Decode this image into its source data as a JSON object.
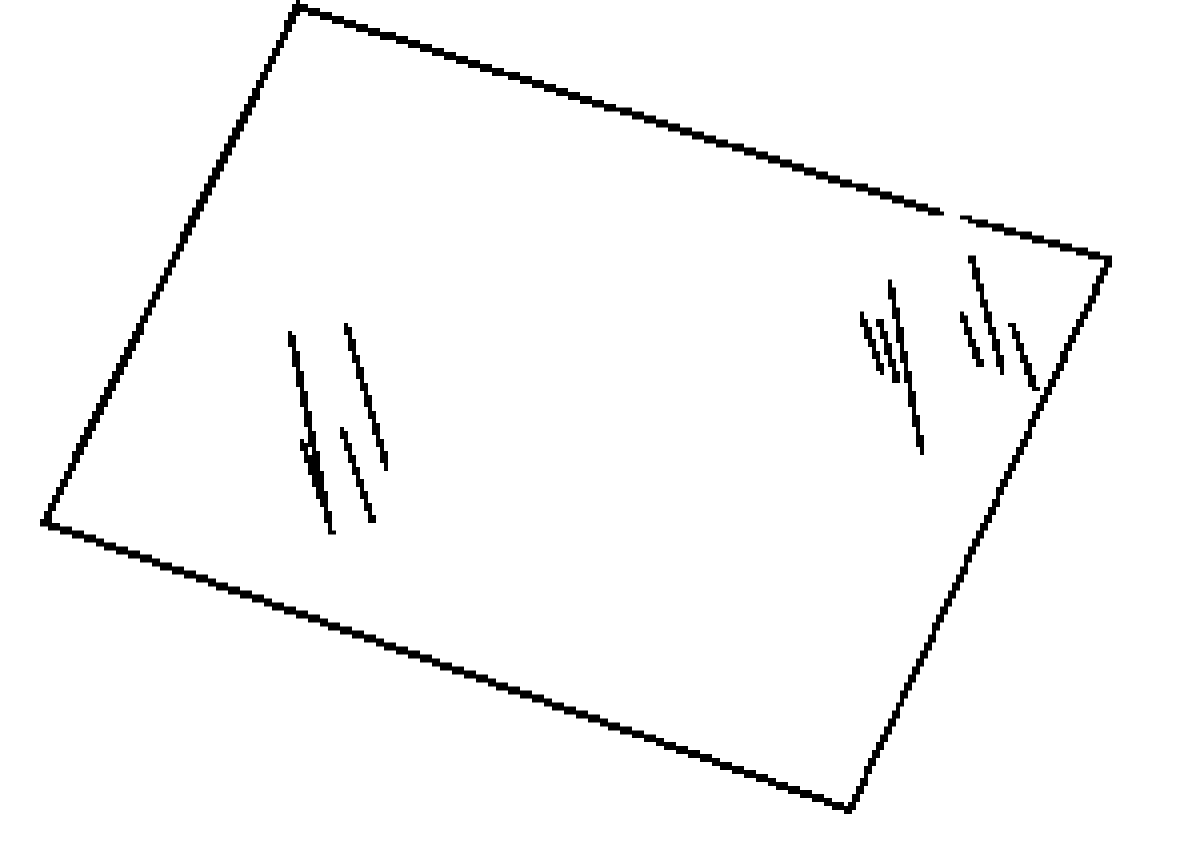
{
  "figure": {
    "description": "Black-and-white line drawing of a tilted rectangular glass pane with diagonal reflection hatch marks",
    "background_color": "#ffffff",
    "stroke_color": "#000000",
    "canvas": {
      "width": 1200,
      "height": 842,
      "pixel_scale": 4
    },
    "pane_outline": {
      "corners": {
        "top": [
          298,
          7
        ],
        "right": [
          1110,
          260
        ],
        "bottom": [
          850,
          812
        ],
        "left": [
          44,
          524
        ]
      },
      "segments": [
        {
          "name": "left-edge",
          "points": [
            [
              298,
              7
            ],
            [
              44,
              524
            ]
          ],
          "width": 7
        },
        {
          "name": "bottom-edge",
          "points": [
            [
              44,
              524
            ],
            [
              850,
              812
            ]
          ],
          "width": 7
        },
        {
          "name": "right-edge",
          "points": [
            [
              850,
              812
            ],
            [
              1110,
              260
            ]
          ],
          "width": 6
        },
        {
          "name": "top-edge-a",
          "points": [
            [
              298,
              7
            ],
            [
              941,
              214
            ]
          ],
          "width": 7
        },
        {
          "name": "top-edge-dot",
          "points": [
            [
              964,
              217
            ],
            [
              972,
              220
            ]
          ],
          "width": 5
        },
        {
          "name": "top-edge-b",
          "points": [
            [
              979,
              223
            ],
            [
              1110,
              260
            ]
          ],
          "width": 6
        }
      ]
    },
    "reflection_marks": {
      "left_group": [
        {
          "name": "left-mark-1",
          "points": [
            [
              291,
              336
            ],
            [
              331,
              533
            ]
          ],
          "width": 5.5
        },
        {
          "name": "left-mark-2",
          "points": [
            [
              347,
              329
            ],
            [
              387,
              468
            ]
          ],
          "width": 5.5
        },
        {
          "name": "left-mark-3",
          "points": [
            [
              303,
              444
            ],
            [
              322,
              503
            ]
          ],
          "width": 5.5
        },
        {
          "name": "left-mark-4",
          "points": [
            [
              342,
              432
            ],
            [
              372,
              521
            ]
          ],
          "width": 5.5
        }
      ],
      "right_inner_group": [
        {
          "name": "right-inner-mark-1",
          "points": [
            [
              862,
              317
            ],
            [
              882,
              373
            ]
          ],
          "width": 5.5
        },
        {
          "name": "right-inner-mark-2",
          "points": [
            [
              880,
              322
            ],
            [
              897,
              382
            ]
          ],
          "width": 5.5
        },
        {
          "name": "right-inner-mark-3",
          "points": [
            [
              890,
              283
            ],
            [
              922,
              453
            ]
          ],
          "width": 5.5
        }
      ],
      "right_outer_group": [
        {
          "name": "right-outer-mark-1",
          "points": [
            [
              963,
              317
            ],
            [
              980,
              365
            ]
          ],
          "width": 5.5
        },
        {
          "name": "right-outer-mark-2",
          "points": [
            [
              972,
              260
            ],
            [
              1003,
              372
            ]
          ],
          "width": 5.5
        },
        {
          "name": "right-outer-mark-3",
          "points": [
            [
              1013,
              327
            ],
            [
              1035,
              390
            ]
          ],
          "width": 5.5
        }
      ]
    }
  }
}
